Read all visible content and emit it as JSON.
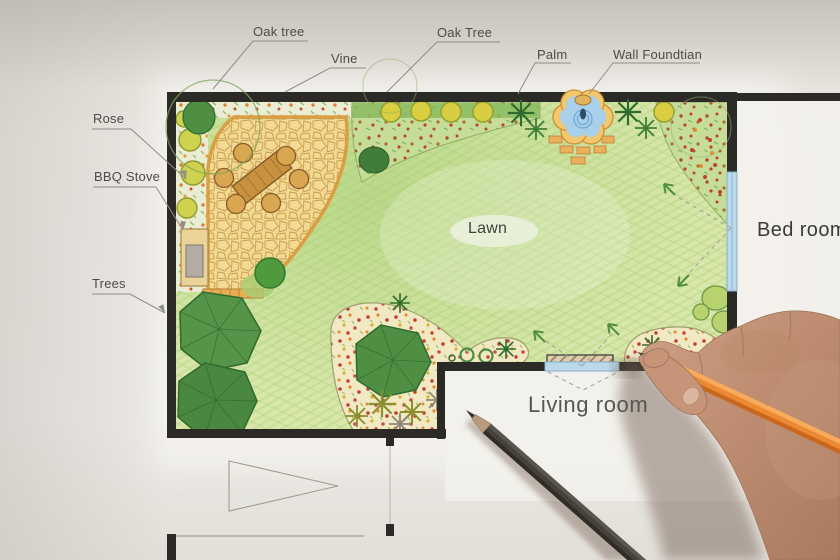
{
  "labels": {
    "oak_tree_left": "Oak tree",
    "vine": "Vine",
    "oak_tree_top": "Oak Tree",
    "palm": "Palm",
    "wall_fountain": "Wall Foundtian",
    "rose": "Rose",
    "bbq_stove": "BBQ Stove",
    "trees": "Trees",
    "lawn": "Lawn",
    "bedroom": "Bed room",
    "living_room": "Living room"
  },
  "colors": {
    "paper": "#e8e5e0",
    "wall_black": "#2b2a27",
    "lawn_green": "#d9e7ad",
    "patio_tan": "#f3d992",
    "patio_border_orange": "#dd9f44",
    "tree_green": "#4f8f44",
    "shrub_yellow": "#d9ce42",
    "bed_cream": "#f0e9c4",
    "flower_red": "#c23f2c",
    "flower_orange": "#e08a32",
    "fountain_water_blue": "#a8d0ea",
    "window_blue": "#bcd9eb",
    "view_arrow_green": "#4f8f3e",
    "label_gray": "#4c4b48",
    "pencil_orange": "#ec8a33",
    "pencil_graphite": "#46413b",
    "hand_skin": "#c2937a"
  }
}
